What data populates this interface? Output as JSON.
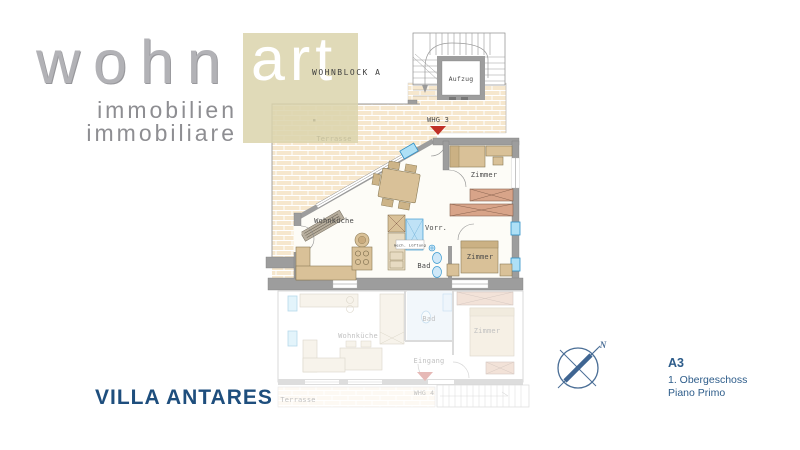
{
  "logo": {
    "word_main": "wohn",
    "word_accent": "art",
    "sub1": "immobilien",
    "sub2": "immobiliare",
    "block_label": "WOHNBLOCK A"
  },
  "title": {
    "text": "VILLA ANTARES"
  },
  "legend": {
    "unit": "A3",
    "floor_de": "1. Obergeschoss",
    "floor_it": "Piano Primo"
  },
  "compass": {
    "north": "N"
  },
  "upper_plan": {
    "unit_label": "WHG 3",
    "terrace": "Terrasse",
    "elevator": "Aufzug",
    "living_kitchen": "Wohnküche",
    "room_top": "Zimmer",
    "room_bottom": "Zimmer",
    "storage": "Vorr.",
    "bath": "Bad",
    "ventilation": "mech. Lüftung"
  },
  "lower_plan": {
    "unit_label": "WHG 4",
    "terrace": "Terrasse",
    "living_kitchen": "Wohnküche",
    "room": "Zimmer",
    "bath": "Bad",
    "entrance": "Eingang"
  },
  "colors": {
    "brand_blue": "#1e4e7d",
    "legend_blue": "#2d5c8a",
    "compass_blue": "#4a6e96",
    "logo_beige": "#dbd3ab",
    "logo_gray": "#b2b2b6",
    "brick": "#f6e7cd",
    "wall_gray": "#9d9d9d",
    "furniture_tan": "#d9c198",
    "wardrobe_salmon": "#d8a489",
    "fixture_blue": "#aee0f6",
    "arrow_red": "#c03026"
  }
}
